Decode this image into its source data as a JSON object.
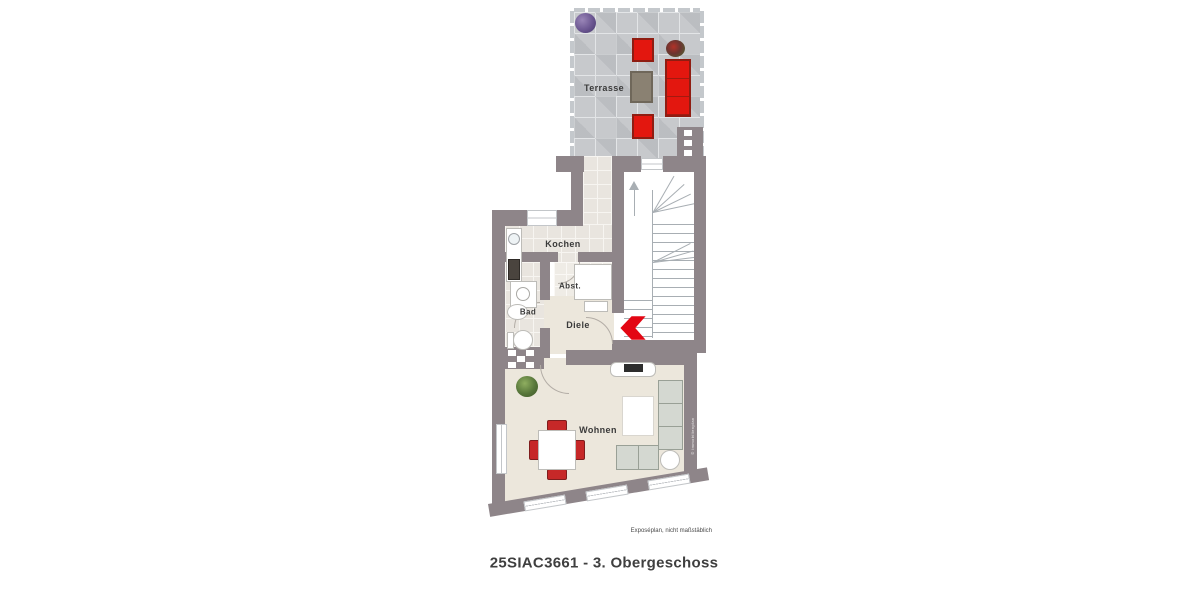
{
  "plan": {
    "title": "25SIAC3661 - 3. Obergeschoss",
    "disclaimer": "Exposéplan, nicht maßstäblich",
    "watermark": "© Immobilienplan",
    "rooms": {
      "terrasse": "Terrasse",
      "kochen": "Kochen",
      "abst": "Abst.",
      "bad": "Bad",
      "diele": "Diele",
      "wohnen": "Wohnen"
    },
    "colors": {
      "wall": "#8e8589",
      "terrace_tile": "#c7c9cc",
      "interior_tile": "#e9e5df",
      "floor_cream": "#ece7dc",
      "accent_red": "#e3170f",
      "sofa_gray": "#d4d8d1"
    },
    "stairs_direction": "up"
  }
}
